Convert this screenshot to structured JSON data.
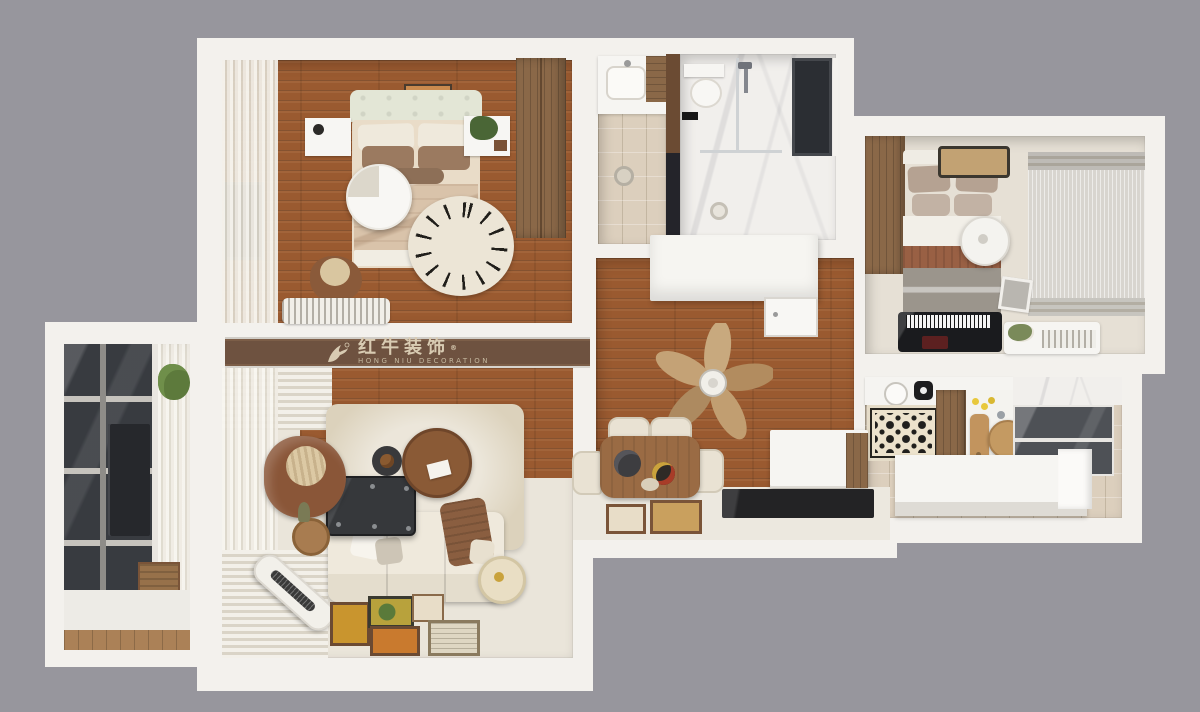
{
  "watermark": {
    "registered_mark": "®",
    "brand_cn": "红牛装饰",
    "brand_en": "HONG NIU DECORATION"
  },
  "palette": {
    "background": "#97969d",
    "wall_white": "#f3f1ed",
    "wood_floor": "#9a5a30",
    "beige_tile": "#dccfbd",
    "living_floor": "#eae5da",
    "furniture_wood": "#8a6848",
    "dark_glass": "#383b40",
    "logo_bar_wood": "#6e5240",
    "logo_text_color": "#d8cbb2"
  }
}
